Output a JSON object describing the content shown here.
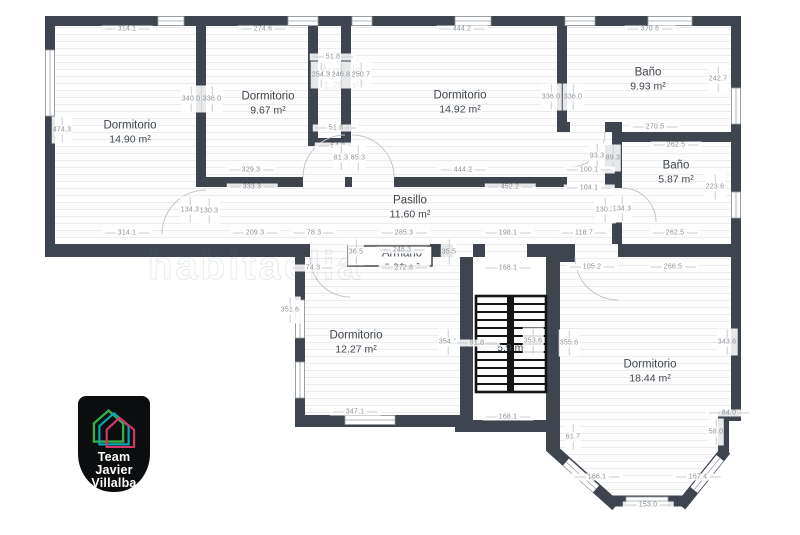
{
  "watermark": {
    "text": "habitaclia"
  },
  "logo": {
    "line1": "Team",
    "line2": "Javier",
    "line3": "Villalba"
  },
  "colors": {
    "wall": "#3e454e",
    "floor_line": "#ececec",
    "dim_text": "#8b9096",
    "dim_line": "#c9ccd0",
    "label_text": "#3f464d",
    "logo_bg": "#0c0d0e",
    "logo_text": "#ffffff",
    "logo_green": "#35ad4b",
    "logo_teal": "#00a9ad",
    "logo_pink": "#d63568"
  },
  "plan": {
    "rooms": [
      {
        "name": "Dormitorio",
        "area": "14.90 m²",
        "x": 130,
        "y": 133
      },
      {
        "name": "Dormitorio",
        "area": "9.67 m²",
        "x": 268,
        "y": 104
      },
      {
        "name": "Armario",
        "area": "1.28 m²",
        "x": 341,
        "y": 79
      },
      {
        "name": "Dormitorio",
        "area": "14.92 m²",
        "x": 460,
        "y": 103
      },
      {
        "name": "Baño",
        "area": "9.93 m²",
        "x": 648,
        "y": 80
      },
      {
        "name": "Baño",
        "area": "5.87 m²",
        "x": 676,
        "y": 173
      },
      {
        "name": "Pasillo",
        "area": "11.60 m²",
        "x": 410,
        "y": 208
      },
      {
        "name": "Armario",
        "area": "0.86 m²",
        "x": 402,
        "y": 261
      },
      {
        "name": "Dormitorio",
        "area": "12.27 m²",
        "x": 356,
        "y": 343
      },
      {
        "name": "",
        "area": "5.9 m²",
        "x": 512,
        "y": 349
      },
      {
        "name": "Dormitorio",
        "area": "18.44 m²",
        "x": 650,
        "y": 372
      }
    ],
    "dims": [
      {
        "t": "314.1",
        "x": 127,
        "y": 29,
        "o": "h"
      },
      {
        "t": "274.6",
        "x": 263,
        "y": 29,
        "o": "h"
      },
      {
        "t": "51.8",
        "x": 333,
        "y": 57,
        "o": "h"
      },
      {
        "t": "444.2",
        "x": 462,
        "y": 29,
        "o": "h"
      },
      {
        "t": "370.6",
        "x": 650,
        "y": 29,
        "o": "h"
      },
      {
        "t": "474.3",
        "x": 62,
        "y": 130,
        "o": "v"
      },
      {
        "t": "340.0",
        "x": 191,
        "y": 99,
        "o": "v"
      },
      {
        "t": "336.0",
        "x": 212,
        "y": 99,
        "o": "v"
      },
      {
        "t": "254.3",
        "x": 321,
        "y": 75,
        "o": "v"
      },
      {
        "t": "246.8",
        "x": 341,
        "y": 75,
        "o": "v"
      },
      {
        "t": "250.7",
        "x": 361,
        "y": 75,
        "o": "v"
      },
      {
        "t": "336.0",
        "x": 551,
        "y": 97,
        "o": "v"
      },
      {
        "t": "336.0",
        "x": 573,
        "y": 97,
        "o": "v"
      },
      {
        "t": "242.7",
        "x": 718,
        "y": 79,
        "o": "v"
      },
      {
        "t": "51.8",
        "x": 336,
        "y": 128,
        "o": "h"
      },
      {
        "t": "54.8",
        "x": 338,
        "y": 146,
        "o": "h"
      },
      {
        "t": "81.3",
        "x": 341,
        "y": 158,
        "o": "v"
      },
      {
        "t": "85.3",
        "x": 358,
        "y": 158,
        "o": "v"
      },
      {
        "t": "329.3",
        "x": 251,
        "y": 170,
        "o": "h"
      },
      {
        "t": "444.2",
        "x": 463,
        "y": 170,
        "o": "h"
      },
      {
        "t": "333.3",
        "x": 252,
        "y": 187,
        "o": "h"
      },
      {
        "t": "452.2",
        "x": 510,
        "y": 187,
        "o": "h"
      },
      {
        "t": "270.5",
        "x": 655,
        "y": 127,
        "o": "h"
      },
      {
        "t": "262.5",
        "x": 676,
        "y": 145,
        "o": "h"
      },
      {
        "t": "93.3",
        "x": 597,
        "y": 156,
        "o": "v"
      },
      {
        "t": "89.3",
        "x": 613,
        "y": 158,
        "o": "v"
      },
      {
        "t": "100.1",
        "x": 589,
        "y": 170,
        "o": "h"
      },
      {
        "t": "104.1",
        "x": 589,
        "y": 188,
        "o": "h"
      },
      {
        "t": "223.6",
        "x": 715,
        "y": 187,
        "o": "v"
      },
      {
        "t": "130.3",
        "x": 605,
        "y": 210,
        "o": "v"
      },
      {
        "t": "134.3",
        "x": 622,
        "y": 209,
        "o": "v"
      },
      {
        "t": "134.3",
        "x": 190,
        "y": 210,
        "o": "v"
      },
      {
        "t": "130.3",
        "x": 209,
        "y": 211,
        "o": "v"
      },
      {
        "t": "314.1",
        "x": 127,
        "y": 233,
        "o": "h"
      },
      {
        "t": "209.3",
        "x": 255,
        "y": 233,
        "o": "h"
      },
      {
        "t": "78.3",
        "x": 314,
        "y": 233,
        "o": "h"
      },
      {
        "t": "285.3",
        "x": 404,
        "y": 233,
        "o": "h"
      },
      {
        "t": "198.1",
        "x": 508,
        "y": 233,
        "o": "h"
      },
      {
        "t": "118.7",
        "x": 584,
        "y": 233,
        "o": "h"
      },
      {
        "t": "262.5",
        "x": 675,
        "y": 233,
        "o": "h"
      },
      {
        "t": "74.3",
        "x": 313,
        "y": 268,
        "o": "h"
      },
      {
        "t": "36.5",
        "x": 356,
        "y": 252,
        "o": "v"
      },
      {
        "t": "248.3",
        "x": 402,
        "y": 250,
        "o": "h"
      },
      {
        "t": "35.5",
        "x": 449,
        "y": 252,
        "o": "v"
      },
      {
        "t": "272.8",
        "x": 404,
        "y": 268,
        "o": "h"
      },
      {
        "t": "168.1",
        "x": 508,
        "y": 268,
        "o": "h"
      },
      {
        "t": "105.2",
        "x": 592,
        "y": 267,
        "o": "h"
      },
      {
        "t": "266.5",
        "x": 673,
        "y": 267,
        "o": "h"
      },
      {
        "t": "351.6",
        "x": 290,
        "y": 310,
        "o": "v"
      },
      {
        "t": "354.1",
        "x": 448,
        "y": 342,
        "o": "v"
      },
      {
        "t": "91.8",
        "x": 477,
        "y": 343,
        "o": "h"
      },
      {
        "t": "353.6",
        "x": 533,
        "y": 341,
        "o": "v"
      },
      {
        "t": "355.6",
        "x": 569,
        "y": 343,
        "o": "v"
      },
      {
        "t": "343.6",
        "x": 727,
        "y": 342,
        "o": "v"
      },
      {
        "t": "347.1",
        "x": 355,
        "y": 412,
        "o": "h"
      },
      {
        "t": "168.1",
        "x": 508,
        "y": 417,
        "o": "h"
      },
      {
        "t": "61.7",
        "x": 573,
        "y": 437,
        "o": "v"
      },
      {
        "t": "84.0",
        "x": 729,
        "y": 413,
        "o": "h"
      },
      {
        "t": "58.0",
        "x": 716,
        "y": 432,
        "o": "v"
      },
      {
        "t": "166.1",
        "x": 597,
        "y": 477,
        "o": "h"
      },
      {
        "t": "167.4",
        "x": 698,
        "y": 477,
        "o": "h"
      },
      {
        "t": "153.0",
        "x": 648,
        "y": 505,
        "o": "h"
      }
    ]
  }
}
